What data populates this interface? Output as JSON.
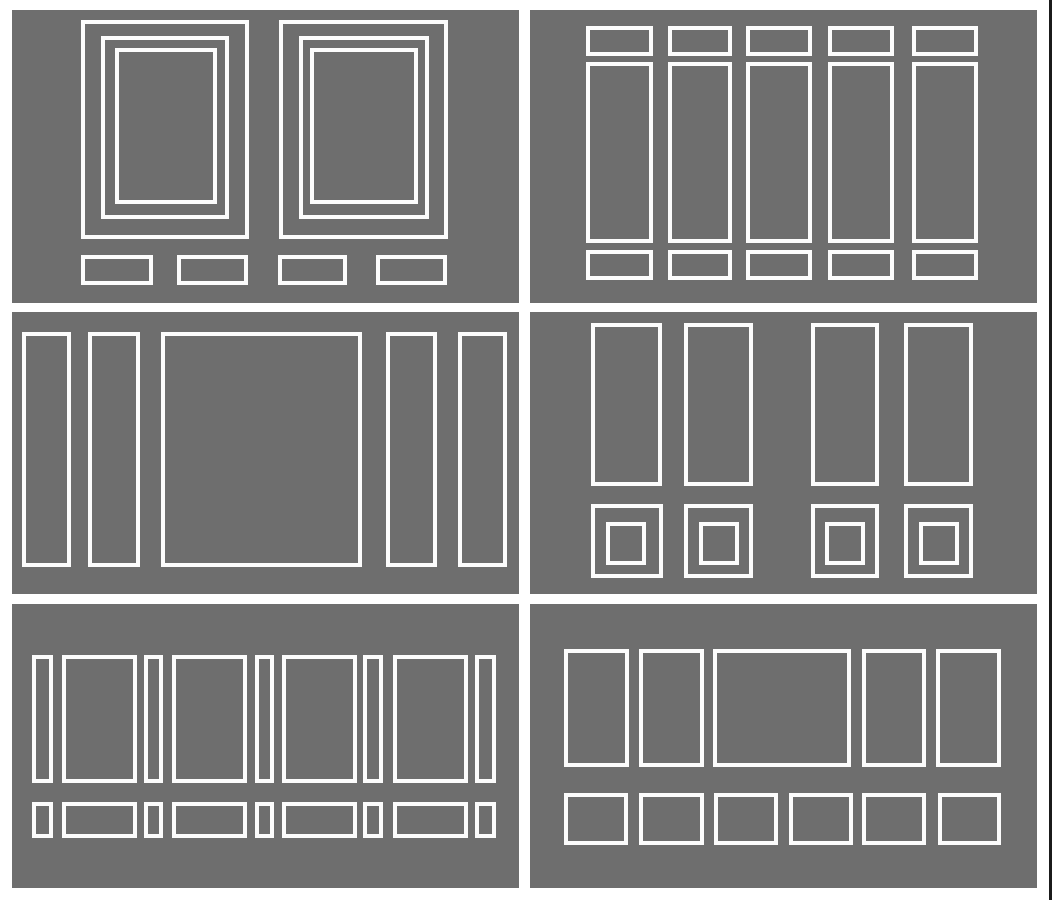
{
  "colors": {
    "page_background": "#ffffff",
    "panel_background": "#6e6e6e",
    "outline": "#fcfcfc",
    "right_edge_line": "#1b1b1b"
  },
  "canvas": {
    "width": 1052,
    "height": 900
  },
  "diagram": {
    "kind": "wall-molding-layout-samples",
    "grid": {
      "rows": 3,
      "columns": 2
    },
    "panels": [
      {
        "name": "panel-nested-picture-frames-with-base-blocks",
        "x": 12,
        "y": 10,
        "w": 507,
        "h": 293,
        "rects": [
          [
            69,
            10,
            168,
            219
          ],
          [
            89,
            26,
            128,
            183
          ],
          [
            103,
            38,
            102,
            156
          ],
          [
            267,
            10,
            169,
            219
          ],
          [
            287,
            26,
            130,
            183
          ],
          [
            298,
            38,
            108,
            156
          ],
          [
            69,
            245,
            72,
            30
          ],
          [
            165,
            245,
            71,
            30
          ],
          [
            266,
            245,
            69,
            30
          ],
          [
            364,
            245,
            71,
            30
          ]
        ]
      },
      {
        "name": "panel-five-columns-header-body-footer",
        "x": 530,
        "y": 10,
        "w": 507,
        "h": 293,
        "rects": [
          [
            56,
            16,
            67,
            30
          ],
          [
            138,
            16,
            64,
            30
          ],
          [
            216,
            16,
            66,
            30
          ],
          [
            298,
            16,
            66,
            30
          ],
          [
            382,
            16,
            66,
            30
          ],
          [
            56,
            52,
            67,
            181
          ],
          [
            138,
            52,
            64,
            181
          ],
          [
            216,
            52,
            66,
            181
          ],
          [
            298,
            52,
            66,
            181
          ],
          [
            382,
            52,
            66,
            181
          ],
          [
            56,
            240,
            67,
            30
          ],
          [
            138,
            240,
            64,
            30
          ],
          [
            216,
            240,
            66,
            30
          ],
          [
            298,
            240,
            66,
            30
          ],
          [
            382,
            240,
            66,
            30
          ]
        ]
      },
      {
        "name": "panel-center-square-with-side-columns",
        "x": 12,
        "y": 312,
        "w": 507,
        "h": 282,
        "rects": [
          [
            10,
            20,
            49,
            235
          ],
          [
            76,
            20,
            52,
            235
          ],
          [
            149,
            20,
            201,
            235
          ],
          [
            374,
            20,
            51,
            235
          ],
          [
            446,
            20,
            49,
            235
          ]
        ]
      },
      {
        "name": "panel-tall-panels-over-nested-squares",
        "x": 530,
        "y": 312,
        "w": 507,
        "h": 282,
        "rects": [
          [
            61,
            11,
            71,
            163
          ],
          [
            154,
            11,
            69,
            163
          ],
          [
            281,
            11,
            68,
            163
          ],
          [
            374,
            11,
            69,
            163
          ],
          [
            61,
            192,
            72,
            74
          ],
          [
            154,
            192,
            69,
            74
          ],
          [
            281,
            192,
            68,
            74
          ],
          [
            374,
            192,
            69,
            74
          ],
          [
            76,
            210,
            40,
            43
          ],
          [
            169,
            210,
            40,
            43
          ],
          [
            295,
            210,
            40,
            43
          ],
          [
            389,
            210,
            40,
            43
          ]
        ]
      },
      {
        "name": "panel-alternating-narrow-wide-two-tier",
        "x": 12,
        "y": 604,
        "w": 507,
        "h": 284,
        "rects": [
          [
            20,
            51,
            21,
            128
          ],
          [
            50,
            51,
            75,
            128
          ],
          [
            132,
            51,
            19,
            128
          ],
          [
            160,
            51,
            75,
            128
          ],
          [
            243,
            51,
            19,
            128
          ],
          [
            270,
            51,
            75,
            128
          ],
          [
            351,
            51,
            20,
            128
          ],
          [
            381,
            51,
            75,
            128
          ],
          [
            463,
            51,
            21,
            128
          ],
          [
            20,
            198,
            21,
            36
          ],
          [
            50,
            198,
            75,
            36
          ],
          [
            132,
            198,
            19,
            36
          ],
          [
            160,
            198,
            75,
            36
          ],
          [
            243,
            198,
            19,
            36
          ],
          [
            270,
            198,
            75,
            36
          ],
          [
            351,
            198,
            20,
            36
          ],
          [
            381,
            198,
            75,
            36
          ],
          [
            463,
            198,
            21,
            36
          ]
        ]
      },
      {
        "name": "panel-mixed-width-upper-row-with-base-row",
        "x": 530,
        "y": 604,
        "w": 507,
        "h": 284,
        "rects": [
          [
            34,
            45,
            65,
            118
          ],
          [
            109,
            45,
            65,
            118
          ],
          [
            183,
            45,
            138,
            118
          ],
          [
            332,
            45,
            64,
            118
          ],
          [
            406,
            45,
            65,
            118
          ],
          [
            34,
            189,
            64,
            52
          ],
          [
            109,
            189,
            65,
            52
          ],
          [
            184,
            189,
            64,
            52
          ],
          [
            259,
            189,
            64,
            52
          ],
          [
            332,
            189,
            64,
            52
          ],
          [
            408,
            189,
            63,
            52
          ]
        ]
      }
    ]
  }
}
